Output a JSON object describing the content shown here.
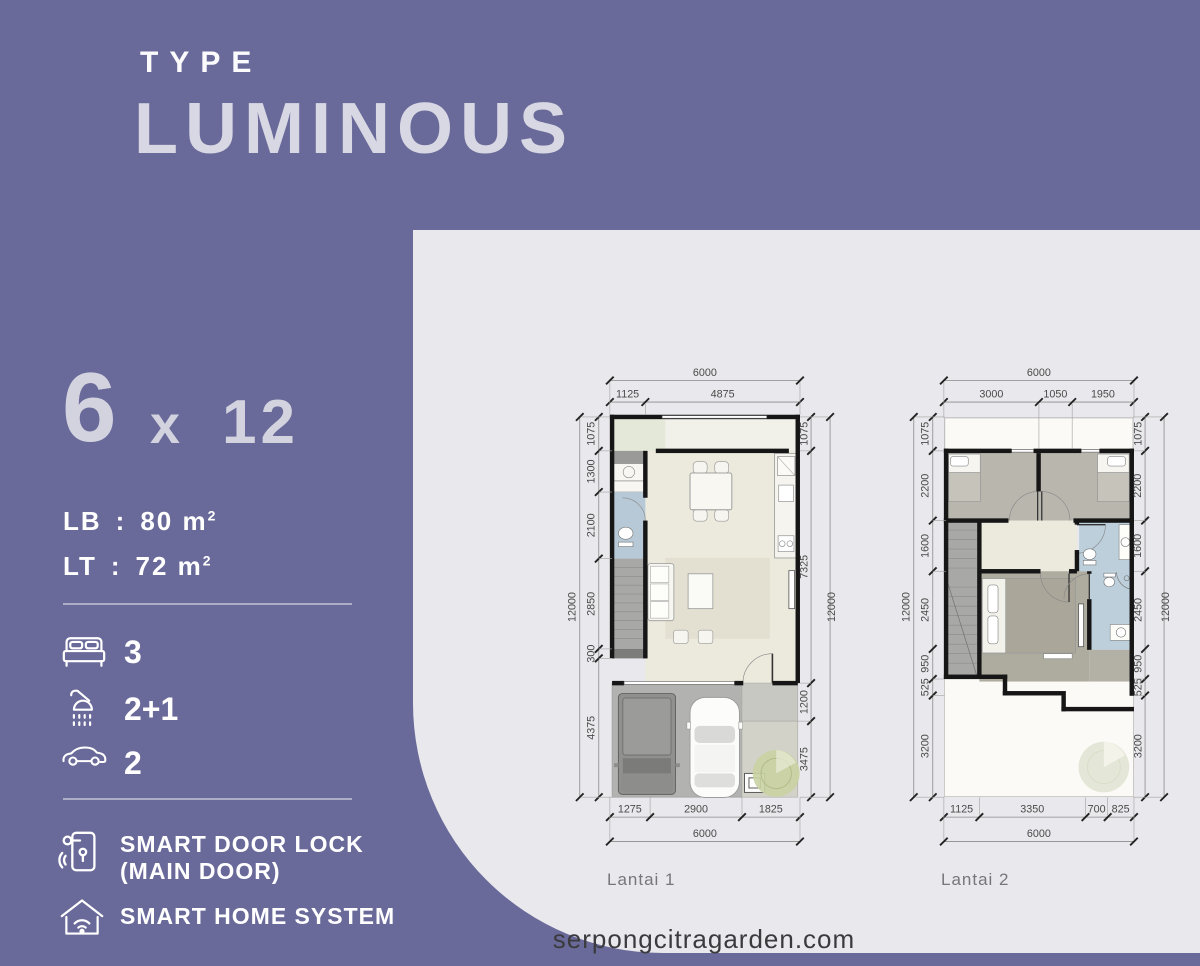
{
  "title": {
    "eyebrow": "TYPE",
    "name": "LUMINOUS"
  },
  "size": {
    "width": "6",
    "separator": "x",
    "depth": "12"
  },
  "area": [
    {
      "label": "LB",
      "sep": ":",
      "value": "80",
      "unit": "m",
      "sup": "2"
    },
    {
      "label": "LT",
      "sep": ":",
      "value": "72",
      "unit": "m",
      "sup": "2"
    }
  ],
  "specs": [
    {
      "icon": "bed-icon",
      "value": "3"
    },
    {
      "icon": "shower-icon",
      "value": "2+1"
    },
    {
      "icon": "car-icon",
      "value": "2"
    }
  ],
  "features": [
    {
      "icon": "smart-door-lock-icon",
      "line1": "SMART DOOR LOCK",
      "line2": "(MAIN DOOR)"
    },
    {
      "icon": "smart-home-icon",
      "line1": "SMART HOME SYSTEM"
    }
  ],
  "plans": {
    "lantai1": {
      "label": "Lantai 1",
      "dims": {
        "top_total": "6000",
        "top": [
          "1125",
          "4875"
        ],
        "left_total": "12000",
        "left": [
          "1075",
          "1300",
          "2100",
          "2850",
          "300",
          "4375"
        ],
        "right_total": "12000",
        "right": [
          "1075",
          "7325",
          "1200",
          "3475"
        ],
        "bottom_total": "6000",
        "bottom": [
          "1275",
          "2900",
          "1825"
        ]
      }
    },
    "lantai2": {
      "label": "Lantai 2",
      "dims": {
        "top_total": "6000",
        "top": [
          "3000",
          "1050",
          "1950"
        ],
        "left_total": "12000",
        "left": [
          "1075",
          "2200",
          "1600",
          "2450",
          "950",
          "525",
          "3200"
        ],
        "right_total": "12000",
        "right": [
          "1075",
          "2200",
          "1600",
          "2450",
          "950",
          "525",
          "3200"
        ],
        "bottom_total": "6000",
        "bottom": [
          "1125",
          "3350",
          "700",
          "825"
        ]
      }
    }
  },
  "footer": {
    "website": "serpongcitragarden.com"
  },
  "colors": {
    "background": "#6a6a9a",
    "panel": "#e9e8ec",
    "title_text": "#d8d8e4",
    "wall": "#161616",
    "floor_cream": "#ece9dd",
    "floor_gray": "#b1b1ae",
    "bath_blue": "#bccfdb",
    "greenery": "#c9d2a2",
    "dimension_text": "#4a4a4a"
  }
}
